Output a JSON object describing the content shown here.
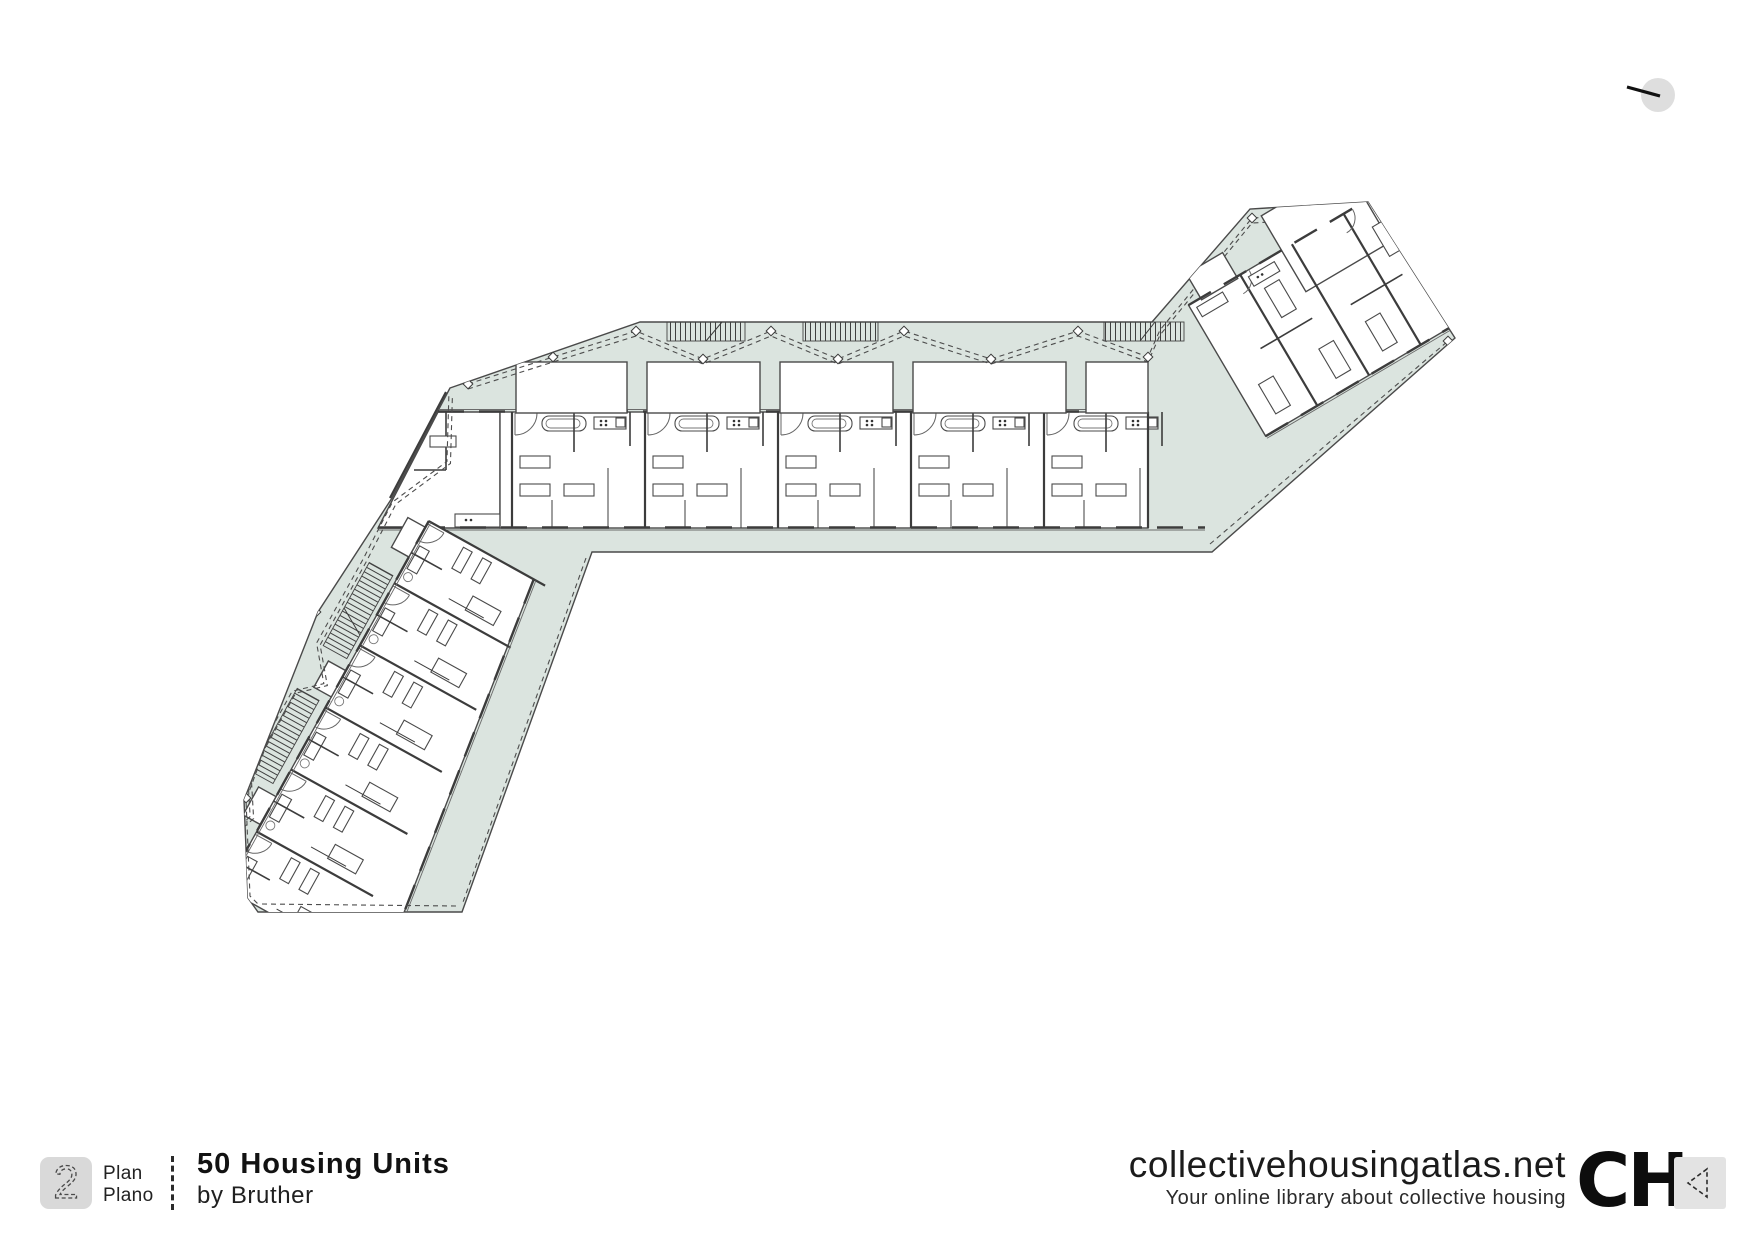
{
  "plan_sheet": {
    "drawing": "architectural-floor-plan",
    "shape": "boomerang-three-wings",
    "visible_text_in_drawing": ""
  },
  "footer": {
    "page_badge": {
      "number": "2"
    },
    "labels": {
      "en": "Plan",
      "es": "Plano"
    },
    "project": {
      "title": "50 Housing Units",
      "byline": "by Bruther"
    },
    "site": {
      "domain": "collectivehousingatlas.net",
      "tagline": "Your online library about collective housing",
      "logo_text": "CH"
    }
  },
  "icons": {
    "compass": "north-indicator-icon",
    "back": "dashed-left-arrow-icon"
  },
  "colors": {
    "paper": "#ffffff",
    "tint": "#dbe4df",
    "wall": "#3c3c3c",
    "line": "#4a4a4a",
    "ink": "#1c1c1c",
    "badgeBg": "#d9d9d9",
    "iconGray": "#dedede"
  }
}
